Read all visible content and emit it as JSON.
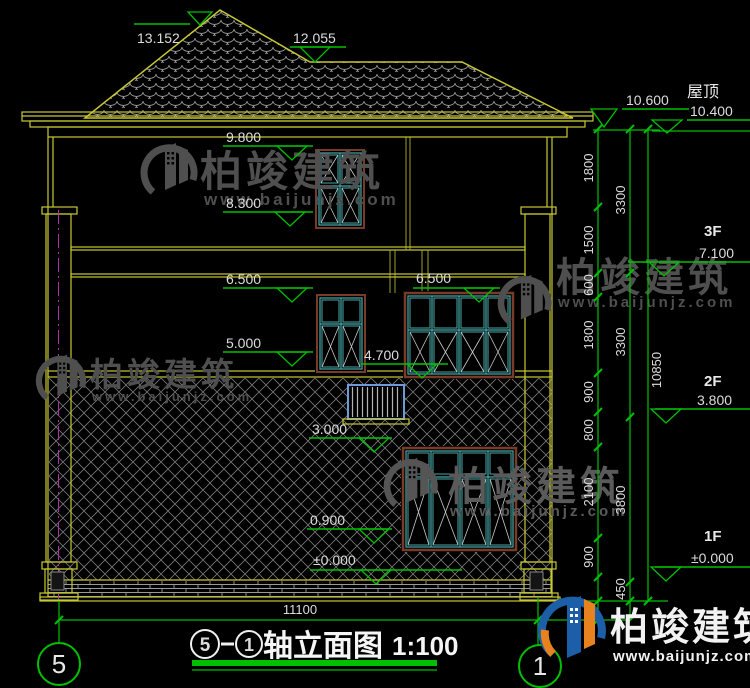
{
  "drawing": {
    "levels_left": {
      "peak": "13.152",
      "ridge": "12.055",
      "eave_top": "9.800",
      "w3_sill": "8.300",
      "w2_head_a": "6.500",
      "w2_head_b": "6.500",
      "w2_sill": "5.000",
      "balcony_head": "4.700",
      "rail_top": "3.000",
      "w1_sill": "0.900",
      "ground": "±0.000"
    },
    "levels_right": {
      "roof_label": "屋顶",
      "parapet": "10.600",
      "eave": "10.400",
      "f3_label": "3F",
      "f3_level": "7.100",
      "f2_label": "2F",
      "f2_level": "3.800",
      "f1_label": "1F",
      "f1_level": "±0.000"
    },
    "dims_right_inner": [
      "1800",
      "1500",
      "600",
      "1800",
      "900",
      "800",
      "2100",
      "900",
      "450"
    ],
    "dims_right_middle": [
      "3300",
      "3300",
      "3800",
      "450"
    ],
    "dims_right_total": "10850",
    "dim_bottom_width": "11100",
    "axis_bubbles": {
      "left": "5",
      "right": "1"
    },
    "title": {
      "axis_left": "5",
      "axis_right": "1",
      "name": "轴立面图",
      "scale": "1:100"
    }
  },
  "watermark": {
    "brand": "柏竣建筑",
    "url": "www.baijunjz.com"
  },
  "logo": {
    "brand": "柏竣建筑",
    "url": "www.baijunjz.com"
  }
}
